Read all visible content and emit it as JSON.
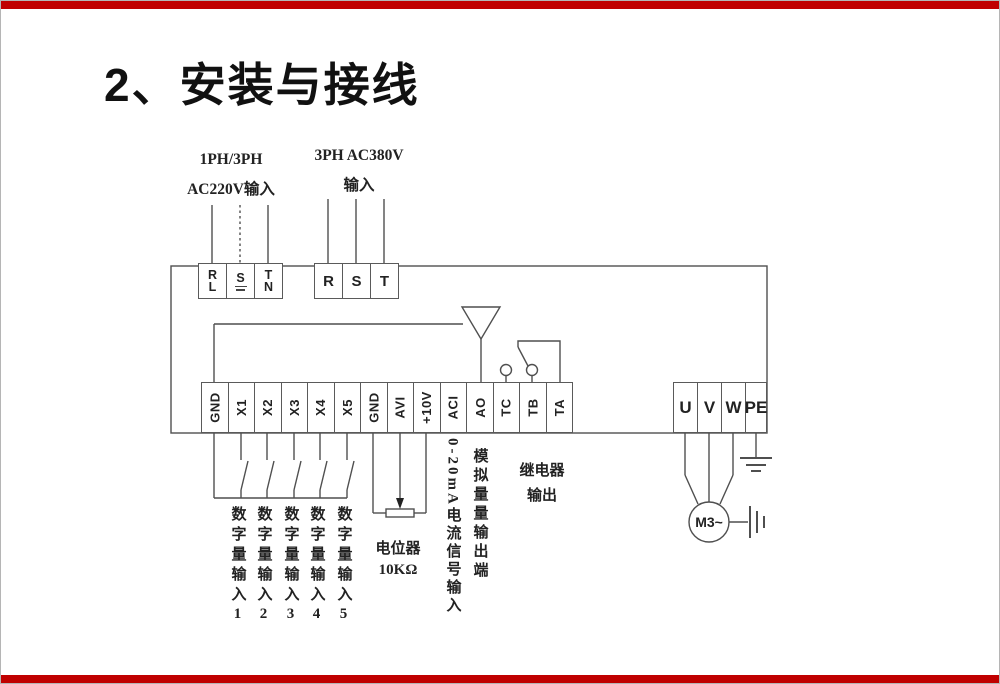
{
  "page": {
    "background": "#ffffff",
    "accent_bar_color": "#c00000",
    "line_color": "#4f4f4f"
  },
  "title": "2、安装与接线",
  "power_inputs": {
    "single_phase": {
      "label_line1": "1PH/3PH",
      "label_line2": "AC220V输入",
      "terminals": [
        {
          "top": "R",
          "bottom": "L"
        },
        {
          "top": "S",
          "bottom": ""
        },
        {
          "top": "T",
          "bottom": "N"
        }
      ]
    },
    "three_phase": {
      "label_line1": "3PH  AC380V",
      "label_line2": "输入",
      "terminals": [
        "R",
        "S",
        "T"
      ]
    }
  },
  "control_terminals": [
    "GND",
    "X1",
    "X2",
    "X3",
    "X4",
    "X5",
    "GND",
    "AVI",
    "+10V",
    "ACI",
    "AO",
    "TC",
    "TB",
    "TA"
  ],
  "output_terminals": [
    "U",
    "V",
    "W",
    "PE"
  ],
  "annotations": {
    "digital_inputs": [
      "数字量输入1",
      "数字量输入2",
      "数字量输入3",
      "数字量输入4",
      "数字量输入5"
    ],
    "potentiometer_line1": "电位器",
    "potentiometer_line2": "10KΩ",
    "current_signal": "0-20mA电流信号输入",
    "analog_output": "模拟量量输出端",
    "relay_line1": "继电器",
    "relay_line2": "输出",
    "motor": "M3~"
  }
}
